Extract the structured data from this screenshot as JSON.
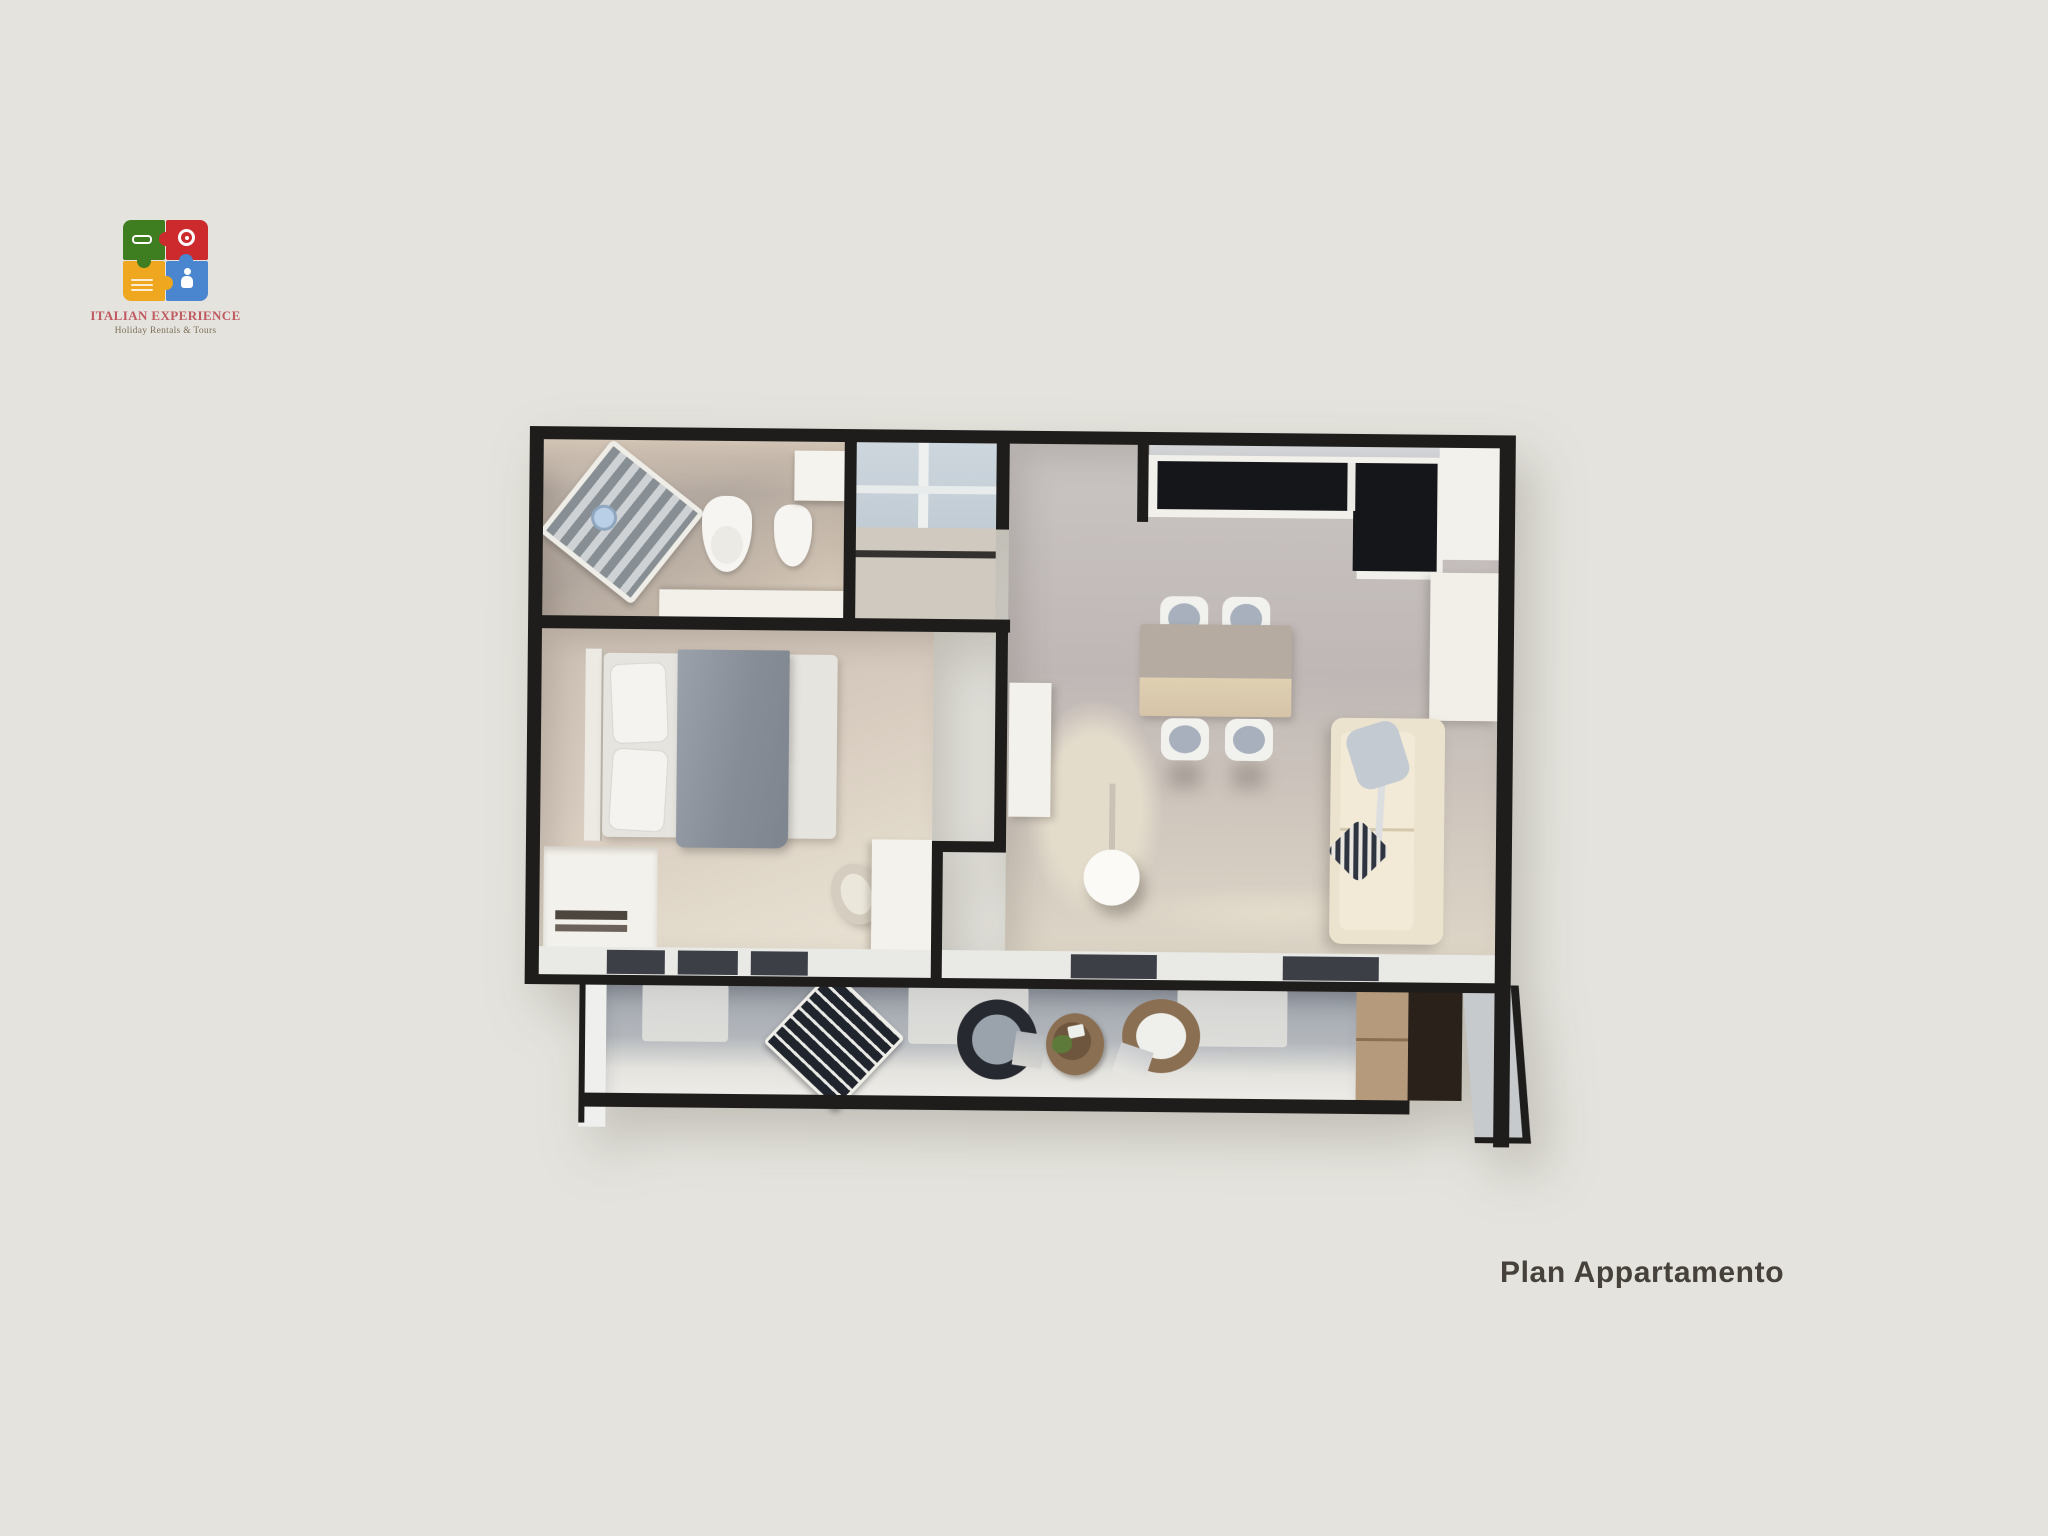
{
  "caption": {
    "text": "Plan Appartamento"
  },
  "logo": {
    "brand": "ITALIAN EXPERIENCE",
    "tagline": "Holiday Rentals & Tours"
  },
  "theme": {
    "bg": "#e4e3dd",
    "wall": "#1e1d1b",
    "caption": "#46413a",
    "bath-floor-a": "#c0b5ab",
    "bath-floor-b": "#b2a79e",
    "bath-floor-c": "#ddd1c0",
    "bed-floor-a": "#cdc0b5",
    "bed-floor-b": "#e9e2d4",
    "living-a": "#c9c4c2",
    "living-b": "#bfb7b5",
    "cream": "#e4dccb",
    "balcony-a": "#9fa5ad",
    "balcony-b": "#efeeea",
    "counter": "#15161a",
    "white-furn": "#f2f0ea",
    "closet": "#c2ccd4",
    "table-top": "#b5aba1",
    "table-band": "#e0d0b2",
    "sofa": "#ece3cf",
    "blanket-a": "#9aa1aa",
    "blanket-b": "#7e858f",
    "wood": "#b59a7c",
    "dark-wood": "#2a211b",
    "pane": "#3c4046",
    "lounger": "#20242c",
    "wicker": "#8a6f52",
    "cushion": "#a7b0bc",
    "plant": "#5d7a3a",
    "brand-green": "#3f7d21",
    "brand-red": "#cd2a2d",
    "brand-yellow": "#efa71f",
    "brand-blue": "#4a86d0",
    "brand-text": "#c05960",
    "tagline-text": "#7d6f58"
  }
}
